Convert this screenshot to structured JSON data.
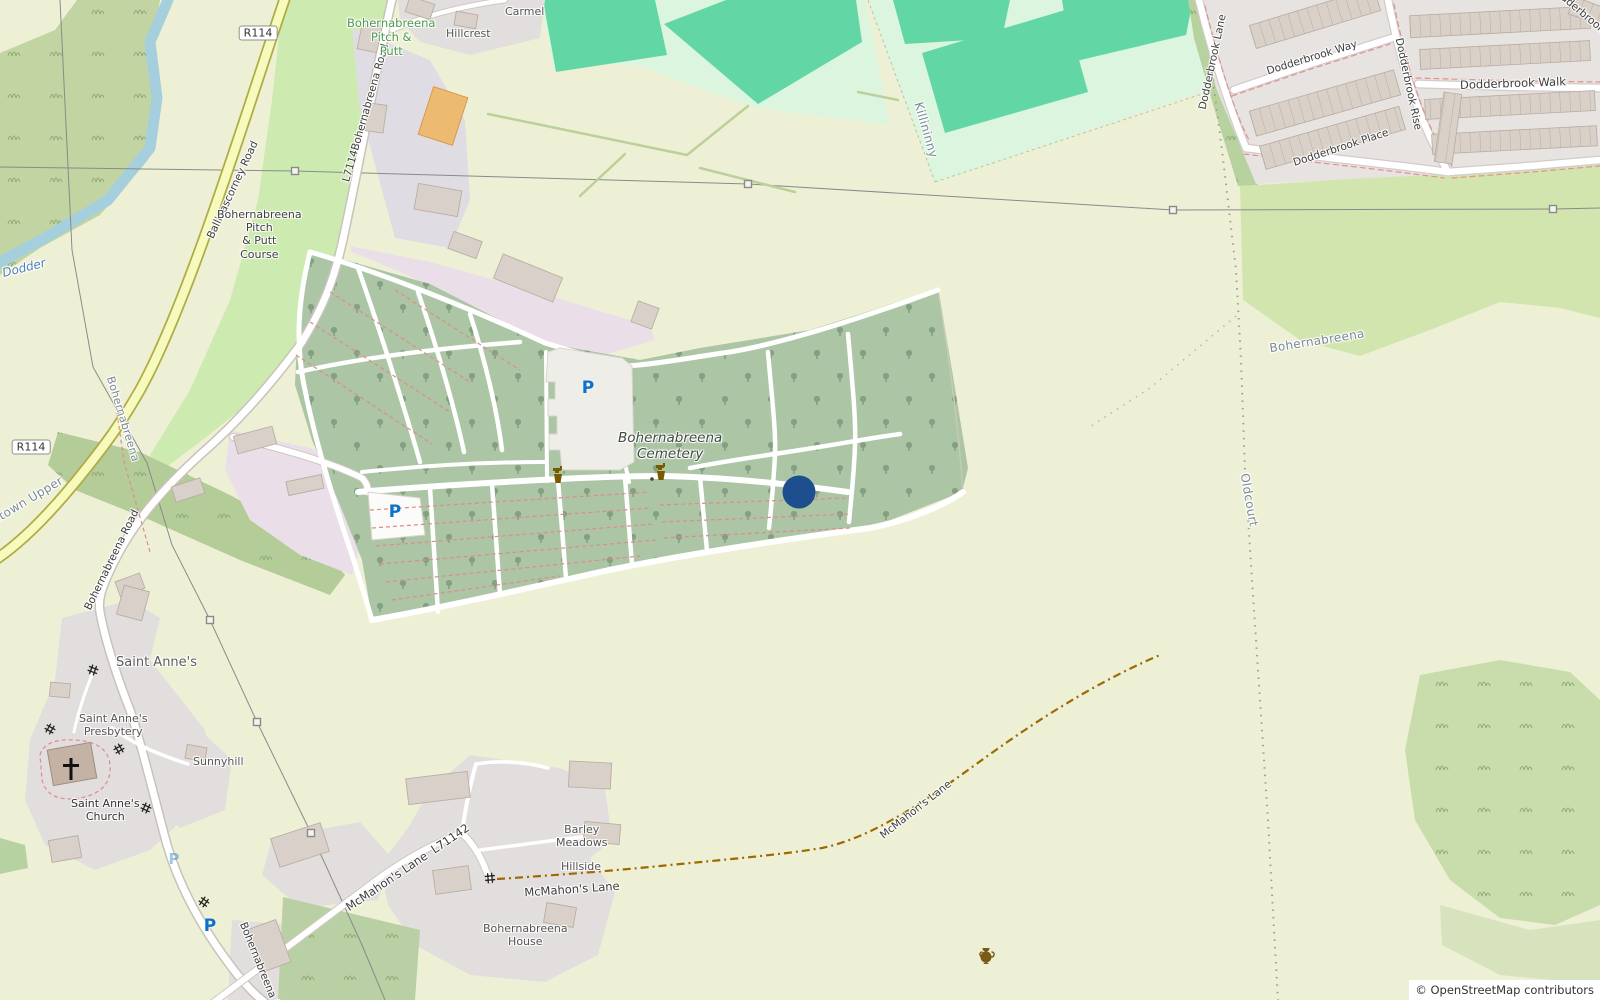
{
  "attribution": {
    "text": "© OpenStreetMap contributors"
  },
  "marker": {
    "name": "selected-location-marker",
    "color": "#1d4f8e"
  },
  "shields": {
    "r114": "R114"
  },
  "roads": {
    "ballinascorney": "Ballinascorney Road",
    "l7114_bohernabreena": "L7114Bohernabreena Road",
    "bohernabreena": "Bohernabreena Road",
    "mcmahons_ref": "McMahon's Lane  L71142",
    "mcmahons": "McMahon's Lane",
    "dodderbrook_lane": "Dodderbrook Lane",
    "dodderbrook_way": "Dodderbrook Way",
    "dodderbrook_rise": "Dodderbrook Rise",
    "dodderbrook_walk": "Dodderbrook Walk",
    "dodderbrook_place": "Dodderbrook Place",
    "dodderbrook_glade": "Dodderbrook Glade"
  },
  "places": {
    "killininny": "Killininny",
    "oldcourt": "Oldcourt",
    "bohernabreena_west": "Bohernabreena",
    "bohernabreena_east": "Bohernabreena",
    "stown_upper": "stown Upper",
    "saint_annes": "Saint Anne's",
    "hillcrest": "Hillcrest",
    "carmel": "Carmel",
    "sunnyhill": "Sunnyhill"
  },
  "features": {
    "dodder_river": "Dodder",
    "pitch_putt": "Bohernabreena\nPitch &\nPutt",
    "pitch_putt_course": "Bohernabreena\nPitch\n& Putt\nCourse",
    "cemetery": "Bohernabreena\nCemetery",
    "presbytery": "Saint Anne's\nPresbytery",
    "church": "Saint Anne's\nChurch",
    "barley_meadows": "Barley\nMeadows",
    "hillside": "Hillside",
    "bohernabreena_house": "Bohernabreena\nHouse"
  },
  "icons": {
    "parking": "P",
    "church_cross": "latin-cross-icon",
    "water_tap": "water-tap-icon",
    "amphora": "archaeological-site-icon",
    "gate": "gate-icon",
    "pylon": "power-pylon-icon"
  },
  "colors": {
    "farmland": "#eef0d5",
    "grass": "#cdebb0",
    "recreation_mint": "#dcf5de",
    "pitch_teal": "#63d6a6",
    "cemetery_green": "#abc5a5",
    "residential_gray": "#e2dedd",
    "pink_area": "#eadfe9",
    "secondary_road": "#f6fabd",
    "water": "#a5cfdd",
    "track_brown": "#9b6a00",
    "marker_blue": "#1d4f8e"
  }
}
